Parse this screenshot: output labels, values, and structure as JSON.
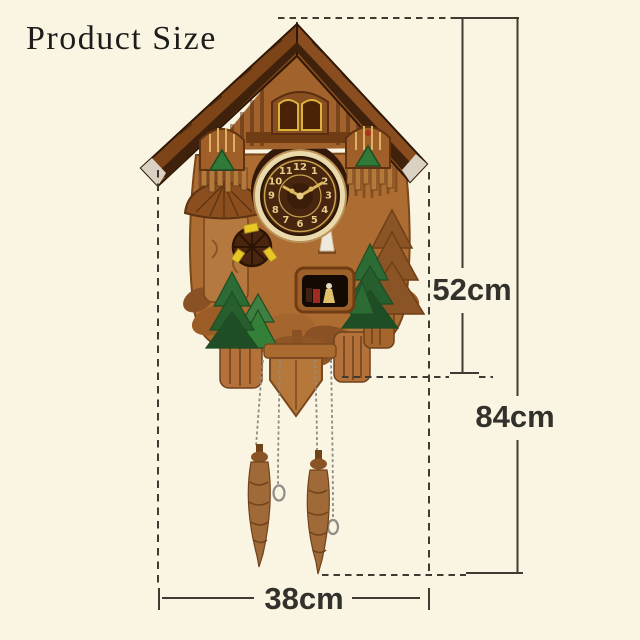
{
  "title": "Product Size",
  "measurements": {
    "body_height": "52cm",
    "total_height": "84cm",
    "width": "38cm"
  },
  "clock": {
    "numerals": [
      "12",
      "1",
      "2",
      "3",
      "4",
      "5",
      "6",
      "7",
      "8",
      "9",
      "10",
      "11"
    ]
  },
  "colors": {
    "background": "#faf4e2",
    "dimension_line": "#3f3b33",
    "label_text": "#33312c",
    "roof_wood": "#7d4418",
    "body_wood": "#ad6c31",
    "dark_wood": "#3a1e08",
    "pine_green": "#2c6b33",
    "gold_accent": "#d9b95c",
    "paddle_yellow": "#e8c623"
  }
}
